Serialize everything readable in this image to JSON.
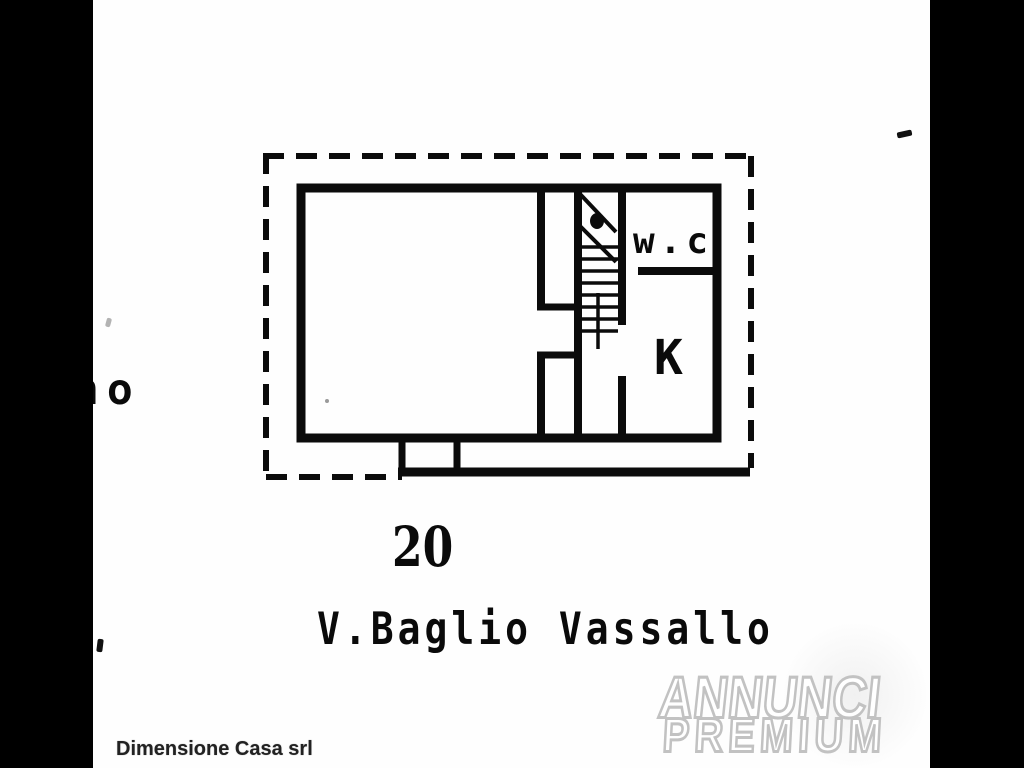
{
  "document": {
    "kind": "scanned cadastral floor plan",
    "left_margin_fragment": "no",
    "street_number": "20",
    "street_name": "V.Baglio Vassallo",
    "rooms": {
      "wc": "w.c",
      "kitchen": "K"
    },
    "footer_company": "Dimensione Casa srl",
    "watermark": {
      "line1": "ANNUNCI",
      "line2": "PREMIUM"
    }
  },
  "colors": {
    "paper": "#fefefe",
    "ink": "#0a0a0a",
    "pillarbox": "#000000",
    "watermark_fill": "#ffffff",
    "watermark_outline": "#c2c2c2",
    "footer_text": "#222222"
  }
}
